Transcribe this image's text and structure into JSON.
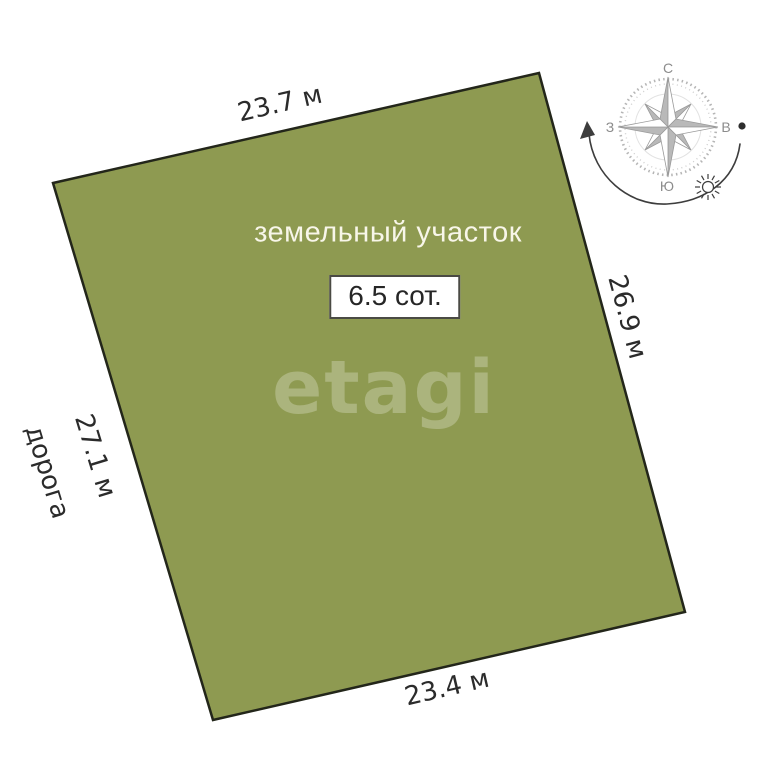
{
  "plot": {
    "title": "земельный участок",
    "area_label": "6.5 сот.",
    "watermark": "etagi"
  },
  "dimensions": {
    "top": "23.7 м",
    "right": "26.9 м",
    "bottom": "23.4 м",
    "left": "27.1 м"
  },
  "labels": {
    "road": "дорога"
  },
  "compass": {
    "north": "С",
    "east": "В",
    "south": "Ю",
    "west": "З",
    "icons": [
      "compass-rose-icon",
      "sun-icon",
      "east-dot",
      "sun-path-arrow"
    ]
  },
  "colors": {
    "background": "#ffffff",
    "plot_fill": "#8e9a51",
    "plot_border": "#23261a",
    "title_text": "#f8f6e9",
    "dimension_text": "#2b2b2b",
    "compass_gray": "#9a9a9a",
    "arc_dark": "#3d3d3d"
  }
}
